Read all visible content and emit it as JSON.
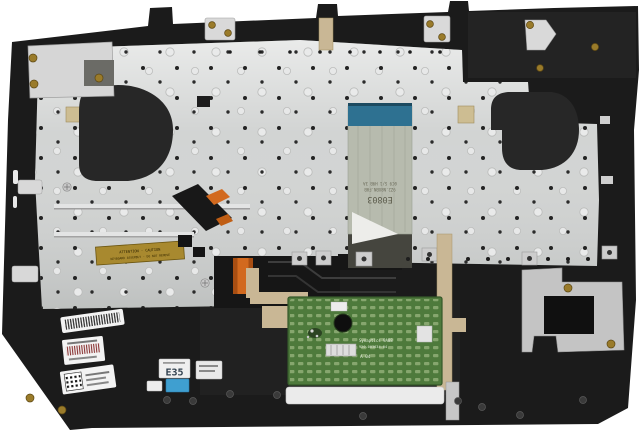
{
  "photo": {
    "subject": "Laptop palmrest keyboard assembly, internal rear view",
    "width": 640,
    "height": 433
  },
  "colors": {
    "background": "#ffffff",
    "chassis": "#1b1b1b",
    "plate": "#d2d4d3",
    "fan_cover": "#272727",
    "cable_body": "#b7bbae",
    "cable_stiffener": "#2e7191",
    "orange_flex": "#d2691e",
    "tan_ribbon": "#c9b795",
    "touchpad_green": "#4e7a3c",
    "gold_label": "#a8892f",
    "foil_sticker": "#c4c4c4",
    "brass_screw": "#9a7b2a",
    "blue_label": "#3f9fd0",
    "sticker_white": "#f3f3f3"
  },
  "labels": {
    "cable": {
      "stamp": "E0803",
      "line1": "9Z2.N8XBN.F0B",
      "line2": "0C9 S/1 H9B 3A"
    },
    "gold": {
      "line1": "ATTENTION - CAUTION",
      "line2": "KEYBOARD ASSEMBLY - DO NOT REMOVE"
    },
    "touchpad": {
      "line1": "Synaptics 9A08",
      "line2": "920-003634-04",
      "line3": "A 04"
    },
    "e35": {
      "big": "E35"
    }
  }
}
